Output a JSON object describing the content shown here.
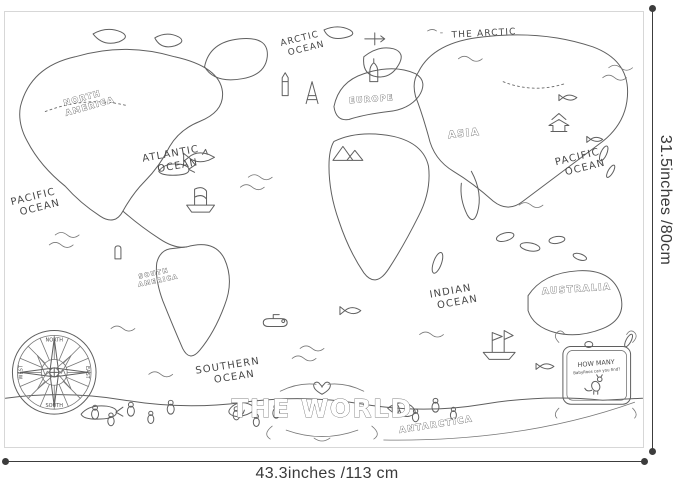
{
  "poster": {
    "title_banner": {
      "text": "THE WORLD"
    },
    "region_labels": {
      "the_arctic": "THE ARCTIC",
      "north_america_line1": "NORTH",
      "north_america_line2": "AMERICA",
      "south_america_line1": "SOUTH",
      "south_america_line2": "AMERICA",
      "europe": "EUROPE",
      "asia": "ASIA",
      "australia": "AUSTRALIA",
      "antarctica": "ANTARCTICA"
    },
    "ocean_labels": {
      "arctic": {
        "line1": "ARCTIC",
        "line2": "OCEAN"
      },
      "atlantic": {
        "line1": "ATLANTIC",
        "line2": "OCEAN"
      },
      "pacific_west": {
        "line1": "PACIFIC",
        "line2": "OCEAN"
      },
      "pacific_east": {
        "line1": "PACIFIC",
        "line2": "OCEAN"
      },
      "indian": {
        "line1": "INDIAN",
        "line2": "OCEAN"
      },
      "southern": {
        "line1": "SOUTHERN",
        "line2": "OCEAN"
      }
    },
    "compass": {
      "north": "NORTH",
      "east": "EAST",
      "south": "SOUTH",
      "west": "WEST"
    },
    "callout": {
      "line1": "HOW MANY",
      "line2": "BabyRoos can you find?"
    },
    "icons": {
      "heart": "♥",
      "compass_rose": "circle-star-rose",
      "fish": "fish-doodle",
      "whale": "whale-doodle",
      "shark": "shark-doodle",
      "ship": "sailing-ship-doodle",
      "submarine": "submarine-doodle",
      "penguin": "penguin-doodle",
      "airplane": "airplane-doodle",
      "kangaroo": "baby-roo-doodle",
      "pyramids": "pyramid-doodle",
      "eiffel_tower": "tower-doodle",
      "clock_tower": "tower-doodle",
      "onion_dome": "dome-doodle",
      "pagoda": "pagoda-doodle",
      "moai": "moai-doodle"
    }
  },
  "dimensions": {
    "width_label": "43.3inches /113 cm",
    "height_label": "31.5inches /80cm"
  },
  "colors": {
    "line_art": "#5f5f5f",
    "dimension": "#3c3c3c",
    "poster_border": "#d7d7d7",
    "background": "#ffffff"
  }
}
